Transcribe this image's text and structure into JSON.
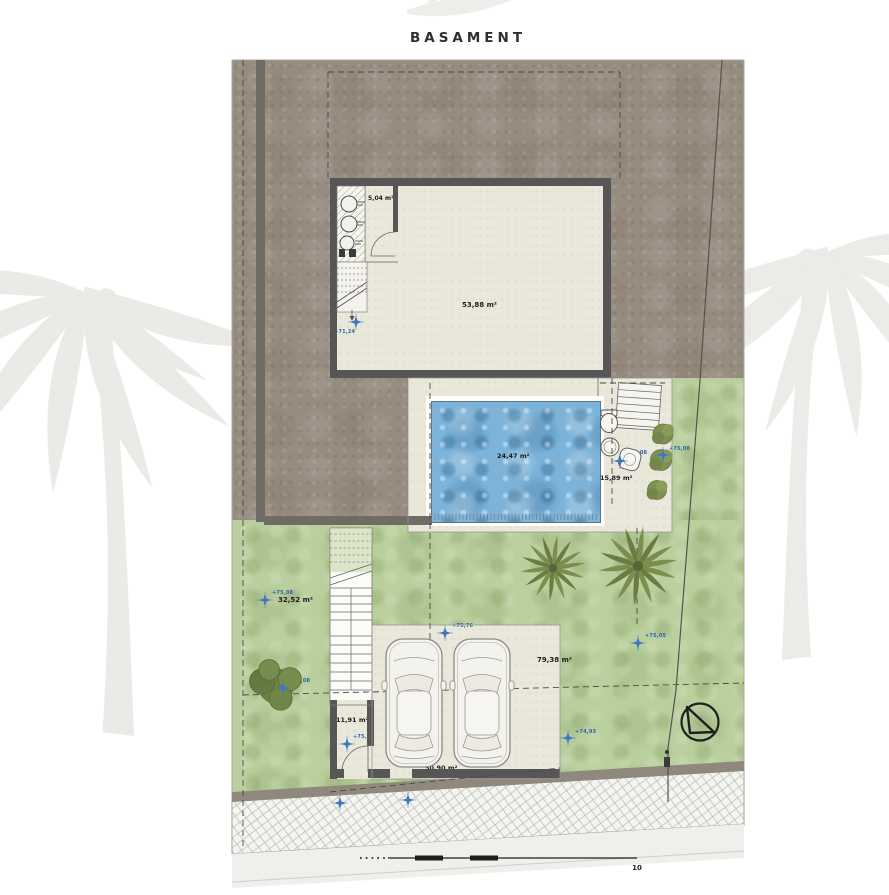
{
  "title": "BASAMENT",
  "plan": {
    "type": "architectural-site-plan",
    "colors": {
      "terrain": "#978c80",
      "grass": "#b9cf9d",
      "floor": "#eae8db",
      "pool_water": "#7db3d8",
      "wall": "#565656",
      "level_marker": "#3f79c2"
    }
  },
  "rooms": [
    {
      "label": "5,04 m²"
    },
    {
      "label": "53,88 m²"
    },
    {
      "label": "24,47 m²"
    },
    {
      "label": "15,89 m²"
    },
    {
      "label": "32,52 m²"
    },
    {
      "label": "79,38 m²"
    },
    {
      "label": "11,91 m²"
    },
    {
      "label": "30,90 m²"
    }
  ],
  "levels": [
    {
      "label": "+71,24"
    },
    {
      "label": "+75,08"
    },
    {
      "label": "+75,08"
    },
    {
      "label": "+75,08"
    },
    {
      "label": "+75,76"
    },
    {
      "label": "+75,48"
    },
    {
      "label": "+74,93"
    },
    {
      "label": "+75,05"
    },
    {
      "label": "+74,76"
    },
    {
      "label": "+74,05"
    },
    {
      "label": "+75,08"
    }
  ],
  "boundary": {
    "limit_label": "LÍMIT"
  },
  "scalebar": {
    "labels": [
      "0",
      "1",
      "2",
      "3",
      "4",
      "5",
      "10"
    ]
  },
  "icons": {
    "north_arrow": "north-arrow",
    "level_marker": "four-point-star",
    "watermark": "palm-tree"
  }
}
